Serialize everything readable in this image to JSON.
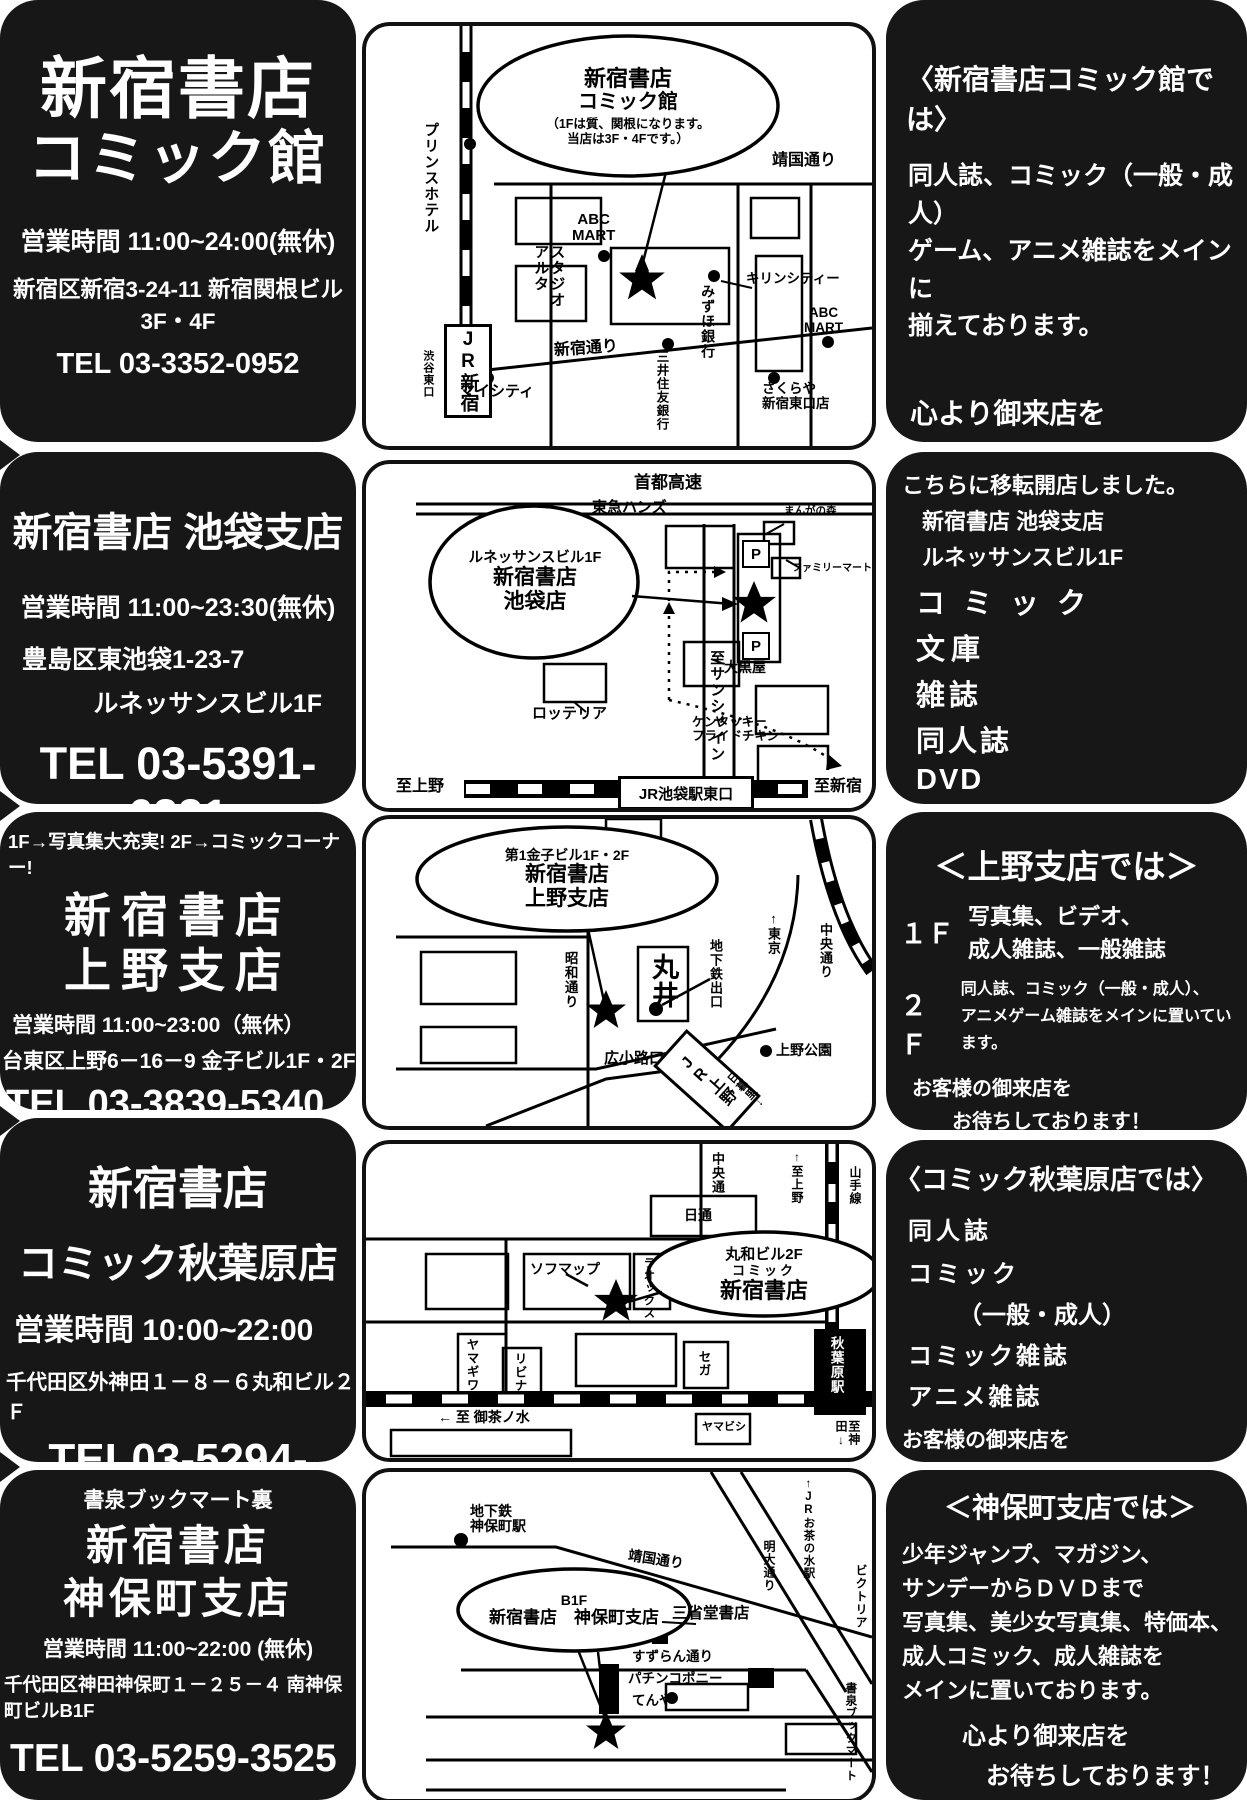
{
  "stores": [
    {
      "title1": "新宿書店",
      "title2": "コミック館",
      "hours": "営業時間  11:00~24:00(無休)",
      "address1": "新宿区新宿3-24-11  新宿関根ビル3F・4F",
      "tel": "TEL 03-3352-0952"
    },
    {
      "title1": "新宿書店  池袋支店",
      "hours": "営業時間  11:00~23:30(無休)",
      "address1": "豊島区東池袋1-23-7",
      "address2": "ルネッサンスビル1F",
      "tel": "TEL 03-5391-6231"
    },
    {
      "note": "1F→写真集大充実!  2F→コミックコーナー!",
      "title1": "新宿書店",
      "title2": "上野支店",
      "hours": "営業時間  11:00~23:00（無休）",
      "address1": "台東区上野6－16－9  金子ビル1F・2F",
      "tel": "TEL 03-3839-5340"
    },
    {
      "title1": "新宿書店",
      "title2": "コミック秋葉原店",
      "hours": "営業時間  10:00~22:00",
      "address1": "千代田区外神田１－８－６丸和ビル２Ｆ",
      "tel": "TEL03-5294-3222"
    },
    {
      "note": "書泉ブックマート裏",
      "title1": "新宿書店",
      "title2": "神保町支店",
      "hours": "営業時間  11:00~22:00 (無休)",
      "address1": "千代田区神田神保町１－２５－４  南神保町ビルB1F",
      "tel": "TEL 03-5259-3525"
    }
  ],
  "infos": [
    {
      "heading": "〈新宿書店コミック館では〉",
      "line1": "同人誌、コミック（一般・成人）",
      "line2": "ゲーム、アニメ雑誌をメインに",
      "line3": "揃えております。",
      "closing1": "心より御来店を",
      "closing2": "お待ちしております！"
    },
    {
      "intro1": "こちらに移転開店しました。",
      "intro2": "新宿書店 池袋支店",
      "intro3": "ルネッサンスビル1F",
      "item1": "コミック",
      "item2": "文庫",
      "item3": "雑誌",
      "item4": "同人誌",
      "item5": "DVD",
      "closing1": "お客様の御来店を",
      "closing2": "お待ちしております！"
    },
    {
      "heading": "＜上野支店では＞",
      "floor1_label": "１Ｆ",
      "floor1a": "写真集、ビデオ、",
      "floor1b": "成人雑誌、一般雑誌",
      "floor2_label": "２Ｆ",
      "floor2a": "同人誌、コミック（一般・成人）、",
      "floor2b": "アニメゲーム雑誌をメインに置いています。",
      "closing1": "お客様の御来店を",
      "closing2": "お待ちしております！"
    },
    {
      "heading": "〈コミック秋葉原店では〉",
      "item1": "同人誌",
      "item2": "コミック",
      "item3": "（一般・成人）",
      "item4": "コミック雑誌",
      "item5": "アニメ雑誌",
      "closing1": "お客様の御来店を",
      "closing2": "お待ちしております！"
    },
    {
      "heading": "＜神保町支店では＞",
      "line1": "少年ジャンプ、マガジン、",
      "line2": "サンデーからＤＶＤまで",
      "line3": "写真集、美少女写真集、特価本、",
      "line4": "成人コミック、成人雑誌を",
      "line5": "メインに置いております。",
      "closing1": "心より御来店を",
      "closing2": "お待ちしております！"
    }
  ],
  "maps": [
    {
      "bubble1": "新宿書店",
      "bubble2": "コミック館",
      "bubble3": "（1Fは質、関根になります。",
      "bubble4": "当店は3F・4Fです。）",
      "labels": {
        "prince": "プリンスホテル",
        "jr": "JR新宿",
        "shibuya": "渋谷東口",
        "yasukuni": "靖国通り",
        "abc1": "ABC\nMART",
        "alta": "スタジオ\nアルタ",
        "mizuho": "みずほ銀行",
        "kirin": "キリンシティー",
        "abc2": "ABC\nMART",
        "shinjukudori": "新宿通り",
        "mitsui": "三井住友銀行",
        "mycity": "マイシティ",
        "sakuraya": "さくらや\n新宿東口店"
      }
    },
    {
      "bubble1": "ルネッサンスビル1F",
      "bubble2": "新宿書店",
      "bubble3": "池袋店",
      "labels": {
        "shuto": "首都高速",
        "tokyu": "東急ハンズ",
        "manga": "まんがの森",
        "famima": "ファミリーマート",
        "p1": "P",
        "p2": "P",
        "sunshine": "至サンシャイン",
        "daikoku": "大黒屋",
        "lotteria": "ロッテリア",
        "kfc": "ケンタッキー\nフライドチキン",
        "toueno": "至上野",
        "station": "JR池袋駅東口",
        "toshinjuku": "至新宿"
      }
    },
    {
      "bubble1": "第1金子ビル1F・2F",
      "bubble2": "新宿書店",
      "bubble3": "上野支店",
      "labels": {
        "tokyo": "↑東京",
        "chuo": "中央通り",
        "showa": "昭和通り",
        "marui": "丸井",
        "subway": "地下鉄出口",
        "hirokoji": "広小路口",
        "jrueno": "JR上野",
        "nippori": "日暮里↓",
        "uenopark": "上野公園"
      }
    },
    {
      "bubble1": "丸和ビル2F",
      "bubble2": "コミック",
      "bubble3": "新宿書店",
      "labels": {
        "chuo": "中央通",
        "toueno": "↑至上野",
        "yamanote": "山手線",
        "nittsu": "日通",
        "sofmap": "ソフマップ",
        "laox": "ラオックス",
        "yamagiwa": "ヤマギワ",
        "livina": "リビナ",
        "sega": "セガ",
        "akihabara": "秋葉原駅",
        "kanda": "至神田↓",
        "ochanomizu": "← 至 御茶ノ水",
        "yamabishi": "ヤマビシ"
      }
    },
    {
      "bubble1": "B1F",
      "bubble2": "新宿書店　神保町支店",
      "labels": {
        "subway": "地下鉄\n神保町駅",
        "yasukuni": "靖国通り",
        "jrocha": "↑JRお茶の水駅",
        "meidai": "明大通り",
        "victoria": "ビクトリア",
        "sanseido": "三省堂書店",
        "suzuran": "すずらん通り",
        "pachinko": "パチンコポニー",
        "tenya": "てんや",
        "shosen": "書泉ブックマート"
      }
    }
  ]
}
